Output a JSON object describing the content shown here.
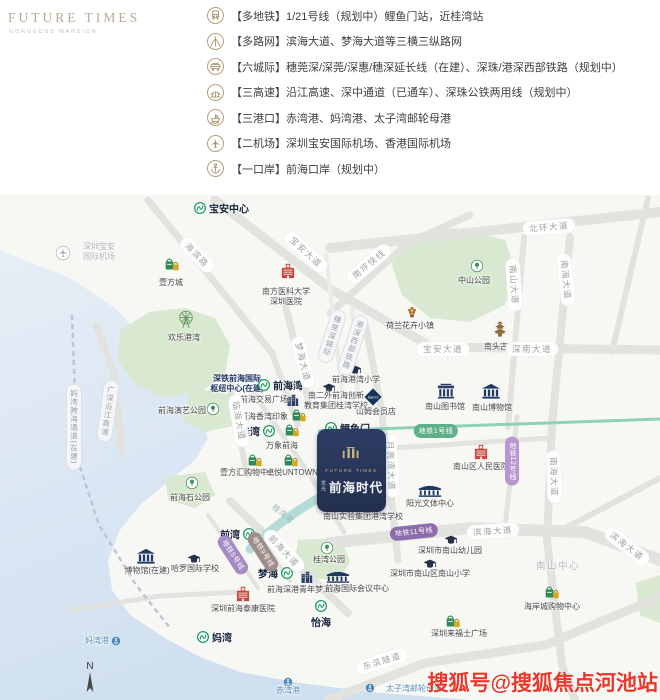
{
  "logo": {
    "title": "FUTURE TIMES",
    "subtitle": "GORGEOUS MANSION"
  },
  "legend": {
    "items": [
      {
        "icon": "train-icon",
        "text": "【多地铁】1/21号线（规划中）鲤鱼门站，近桂湾站"
      },
      {
        "icon": "road-network-icon",
        "text": "【多路网】滨海大道、梦海大道等三横三纵路网"
      },
      {
        "icon": "intercity-rail-icon",
        "text": "【六城际】穗莞深/深莞/深惠/穗深延长线（在建）、深珠/港深西部铁路（规划中）"
      },
      {
        "icon": "highway-icon",
        "text": "【三高速】沿江高速、深中通道（已通车）、深珠公铁两用线（规划中）"
      },
      {
        "icon": "port-icon",
        "text": "【三港口】赤湾港、妈湾港、太子湾邮轮母港"
      },
      {
        "icon": "airplane-icon",
        "text": "【二机场】深圳宝安国际机场、香港国际机场"
      },
      {
        "icon": "anchor-icon",
        "text": "【一口岸】前海口岸（规划中）"
      }
    ]
  },
  "map": {
    "compass_label": "N",
    "watermark": "搜狐号@搜狐焦点河池站",
    "project_card": {
      "brand_en": "FUTURE TIMES",
      "prefix": "龙光",
      "name": "前海时代"
    },
    "stations": [
      {
        "name": "station-baoan-center",
        "label": "宝安中心",
        "x": 200,
        "y": 208,
        "side": "right"
      },
      {
        "name": "station-qianhaiwan",
        "label": "前海湾",
        "x": 264,
        "y": 385,
        "side": "right"
      },
      {
        "name": "station-guiwan",
        "label": "桂湾",
        "x": 269,
        "y": 431,
        "side": "left"
      },
      {
        "name": "station-liyumen",
        "label": "鲤鱼门",
        "x": 331,
        "y": 428,
        "side": "right"
      },
      {
        "name": "station-qianwan",
        "label": "前湾",
        "x": 249,
        "y": 534,
        "side": "left"
      },
      {
        "name": "station-menghai",
        "label": "梦海",
        "x": 287,
        "y": 573,
        "side": "left"
      },
      {
        "name": "station-mawan",
        "label": "妈湾",
        "x": 203,
        "y": 637,
        "side": "right"
      },
      {
        "name": "station-yihai",
        "label": "怡海",
        "x": 321,
        "y": 606,
        "side": "below"
      }
    ],
    "pois": [
      {
        "name": "poi-baoan-airport",
        "icon": "plane",
        "ix": 63,
        "iy": 253,
        "label": [
          "深圳宝安",
          "国际机场"
        ],
        "lx": 99,
        "ly": 252,
        "cls": "faint"
      },
      {
        "name": "poi-yifangcheng",
        "icon": "bag",
        "ix": 172,
        "iy": 263,
        "label": "壹方城",
        "lx": 171,
        "ly": 283
      },
      {
        "name": "poi-nanfang-hospital",
        "icon": "hospital",
        "ix": 288,
        "iy": 271,
        "label": [
          "南方医科大学",
          "深圳医院"
        ],
        "lx": 286,
        "ly": 297
      },
      {
        "name": "poi-happy-harbor",
        "icon": "ferris",
        "ix": 186,
        "iy": 319,
        "label": "欢乐港湾",
        "lx": 184,
        "ly": 338
      },
      {
        "name": "poi-zhongshan-park",
        "icon": "park",
        "ix": 477,
        "iy": 266,
        "label": "中山公园",
        "lx": 474,
        "ly": 281
      },
      {
        "name": "poi-flower-town",
        "icon": "flower",
        "ix": 412,
        "iy": 311,
        "label": "荷兰花卉小镇",
        "lx": 410,
        "ly": 326
      },
      {
        "name": "poi-nantou-old-town",
        "icon": "pagoda",
        "ix": 500,
        "iy": 329,
        "label": "南头古城",
        "lx": 500,
        "ly": 347
      },
      {
        "name": "poi-nanshan-library",
        "icon": "civic",
        "ix": 446,
        "iy": 391,
        "label": "南山图书馆",
        "lx": 445,
        "ly": 407
      },
      {
        "name": "poi-nanshan-museum",
        "icon": "museum",
        "ix": 491,
        "iy": 391,
        "label": "南山博物馆",
        "lx": 492,
        "ly": 408
      },
      {
        "name": "poi-gangwan-primary",
        "icon": "school",
        "ix": 355,
        "iy": 370,
        "label": "前海港湾小学",
        "lx": 356,
        "ly": 380
      },
      {
        "name": "poi-nanerwai-school",
        "icon": "school",
        "ix": 329,
        "iy": 388,
        "label": [
          "南二外前海创新",
          "教育集团桂湾学校"
        ],
        "lx": 336,
        "ly": 401
      },
      {
        "name": "poi-sams-club",
        "icon": "sam",
        "ix": 373,
        "iy": 397,
        "label": "山姆会员店",
        "lx": 376,
        "ly": 412
      },
      {
        "name": "poi-qianhai-hub",
        "label": [
          "深铁前海国际",
          "枢纽中心(在建)"
        ],
        "lx": 237,
        "ly": 384,
        "cls": "navy"
      },
      {
        "name": "poi-exchange-plaza",
        "icon": "tower",
        "ix": 292,
        "iy": 400,
        "label": "前海交易广场",
        "lx": 264,
        "ly": 400
      },
      {
        "name": "poi-xiangwan-impression",
        "icon": "bag",
        "ix": 299,
        "iy": 414,
        "label": "前海香湾印象",
        "lx": 264,
        "ly": 417
      },
      {
        "name": "poi-mixc-qianhai",
        "icon": "bag",
        "ix": 292,
        "iy": 429,
        "label": "万象前海",
        "lx": 282,
        "ly": 446
      },
      {
        "name": "poi-yifanghui-mall",
        "icon": "bag",
        "ix": 255,
        "iy": 459,
        "label": "壹方汇购物中心",
        "lx": 248,
        "ly": 473
      },
      {
        "name": "poi-untown",
        "icon": "bag",
        "ix": 291,
        "iy": 459,
        "label": "卓悦UNTOWN",
        "lx": 292,
        "ly": 473
      },
      {
        "name": "poi-qianhaishi-park",
        "icon": "park",
        "ix": 192,
        "iy": 483,
        "label": "前海石公园",
        "lx": 190,
        "ly": 498
      },
      {
        "name": "poi-performance-park",
        "icon": "park",
        "ix": 213,
        "iy": 409,
        "label": "前海演艺公园",
        "lx": 182,
        "ly": 411
      },
      {
        "name": "poi-museum-uc",
        "icon": "museum",
        "ix": 146,
        "iy": 556,
        "label": "博物馆(在建)",
        "lx": 147,
        "ly": 571
      },
      {
        "name": "poi-harrow-school",
        "icon": "school",
        "ix": 194,
        "iy": 559,
        "label": "哈罗国际学校",
        "lx": 195,
        "ly": 569
      },
      {
        "name": "poi-taikang-hospital",
        "icon": "hospital",
        "ix": 243,
        "iy": 594,
        "label": "深圳前海泰康医院",
        "lx": 243,
        "ly": 609
      },
      {
        "name": "poi-dream-factory",
        "icon": "tower",
        "ix": 306,
        "iy": 577,
        "label": "前海深港青年梦工场",
        "lx": 303,
        "ly": 590
      },
      {
        "name": "poi-intl-conference",
        "icon": "conference",
        "ix": 338,
        "iy": 576,
        "label": "前海国际会议中心",
        "lx": 357,
        "ly": 589
      },
      {
        "name": "poi-guiwan-park",
        "icon": "park",
        "ix": 327,
        "iy": 548,
        "label": "桂湾公园",
        "lx": 329,
        "ly": 560
      },
      {
        "name": "poi-gangwan-school",
        "icon": "school",
        "ix": 362,
        "iy": 506,
        "label": "南山实验集团港湾学校",
        "lx": 363,
        "ly": 517
      },
      {
        "name": "poi-sunshine-center",
        "icon": "conference",
        "ix": 430,
        "iy": 490,
        "label": "阳光文体中心",
        "lx": 430,
        "ly": 504
      },
      {
        "name": "poi-renmin-hospital",
        "icon": "hospital",
        "ix": 481,
        "iy": 452,
        "label": "南山区人民医院",
        "lx": 481,
        "ly": 467
      },
      {
        "name": "poi-nanshan-kindergarten",
        "icon": "school",
        "ix": 451,
        "iy": 540,
        "label": "深圳市南山幼儿园",
        "lx": 450,
        "ly": 551
      },
      {
        "name": "poi-nanshan-primary",
        "icon": "school",
        "ix": 430,
        "iy": 564,
        "label": "深圳市南山区南山小学",
        "lx": 430,
        "ly": 574
      },
      {
        "name": "poi-coastal-city",
        "icon": "bag",
        "ix": 552,
        "iy": 591,
        "label": "海岸城购物中心",
        "lx": 552,
        "ly": 607
      },
      {
        "name": "poi-raffles-city",
        "icon": "bag",
        "ix": 453,
        "iy": 620,
        "label": "深圳来福士广场",
        "lx": 459,
        "ly": 634
      },
      {
        "name": "poi-mawan-port",
        "icon": "anchor",
        "ix": 116,
        "iy": 641,
        "label": "妈湾港",
        "lx": 97,
        "ly": 641,
        "cls": "blue"
      },
      {
        "name": "poi-chiwan-port",
        "icon": "anchor",
        "ix": 288,
        "iy": 682,
        "label": "赤湾港",
        "lx": 288,
        "ly": 691,
        "cls": "blue"
      },
      {
        "name": "poi-taiziwan-port",
        "icon": "anchor",
        "ix": 370,
        "iy": 688,
        "label": "太子湾邮轮母港",
        "lx": 414,
        "ly": 689,
        "cls": "blue"
      },
      {
        "name": "poi-nanshan-center",
        "label": "南山中心",
        "lx": 558,
        "ly": 567,
        "cls": "gray-big"
      }
    ],
    "road_labels": [
      {
        "name": "road-beihuan",
        "text": "北环大道",
        "x": 549,
        "y": 227,
        "rot": -5
      },
      {
        "name": "road-baoan-north",
        "text": "宝安大道",
        "x": 306,
        "y": 252,
        "rot": 43
      },
      {
        "name": "road-haibin",
        "text": "海滨路",
        "x": 197,
        "y": 255,
        "rot": 46
      },
      {
        "name": "road-nanping-express",
        "text": "南坪快线",
        "x": 369,
        "y": 264,
        "rot": -40
      },
      {
        "name": "road-nanshan-ave",
        "text": "南山大道",
        "x": 514,
        "y": 285,
        "rot": 86
      },
      {
        "name": "road-nanhai-north",
        "text": "南海大道",
        "x": 566,
        "y": 280,
        "rot": 84
      },
      {
        "name": "road-baoan-south",
        "text": "宝安大道",
        "x": 443,
        "y": 349,
        "rot": 0
      },
      {
        "name": "road-shennan",
        "text": "深南大道",
        "x": 532,
        "y": 349,
        "rot": 0
      },
      {
        "name": "road-menghai",
        "text": "梦海大道",
        "x": 303,
        "y": 362,
        "rot": 76
      },
      {
        "name": "road-yueliangwan",
        "text": "月亮湾大道",
        "x": 391,
        "y": 466,
        "rot": 87
      },
      {
        "name": "road-linhai",
        "text": "临海大道",
        "x": 239,
        "y": 421,
        "rot": 80
      },
      {
        "name": "road-qianhai-ave",
        "text": "前海大道",
        "x": 284,
        "y": 551,
        "rot": 47
      },
      {
        "name": "road-binhai",
        "text": "滨海大道",
        "x": 493,
        "y": 531,
        "rot": -4
      },
      {
        "name": "road-binhai-east",
        "text": "滨海大道",
        "x": 627,
        "y": 546,
        "rot": 38
      },
      {
        "name": "road-nanhai-south",
        "text": "南海大道",
        "x": 554,
        "y": 477,
        "rot": 88
      },
      {
        "name": "road-dongbin-tunnel",
        "text": "东滨隧道",
        "x": 382,
        "y": 661,
        "rot": -17
      }
    ],
    "rail_labels": [
      {
        "name": "rail-yanjiang-expressway",
        "text": "广深沿江高速",
        "x": 108,
        "y": 411,
        "rot": 8
      },
      {
        "name": "rail-mawan-crossing",
        "text": "妈湾跨海通道(在建)",
        "x": 74,
        "y": 427,
        "rot": 0
      },
      {
        "name": "rail-suiwanshen",
        "text": "穗莞深城际",
        "x": 332,
        "y": 336,
        "rot": 18
      },
      {
        "name": "rail-gangshen-west",
        "text": "港深西部铁路",
        "x": 353,
        "y": 345,
        "rot": 18
      }
    ],
    "metro_labels": [
      {
        "name": "metro-line1-label",
        "text": "地铁1号线",
        "x": 436,
        "y": 431,
        "rot": 0,
        "color": "#5fb08a"
      },
      {
        "name": "metro-line11-label",
        "text": "地铁11号线",
        "x": 414,
        "y": 532,
        "rot": -6,
        "color": "#8d6cab"
      },
      {
        "name": "metro-line12-label",
        "text": "地铁12号线",
        "x": 512,
        "y": 461,
        "rot": 0,
        "color": "#b697cf",
        "vertical": true
      },
      {
        "name": "metro-line5-label",
        "text": "地铁5号线",
        "x": 233,
        "y": 555,
        "rot": 57,
        "color": "#a58bc4"
      },
      {
        "name": "metro-line9-label",
        "text": "地铁9号线",
        "x": 263,
        "y": 552,
        "rot": 57,
        "color": "#9e8d89"
      }
    ],
    "texts": [
      {
        "name": "river-guiwan",
        "text": "桂湾河",
        "x": 283,
        "y": 514,
        "rot": 40
      }
    ]
  }
}
